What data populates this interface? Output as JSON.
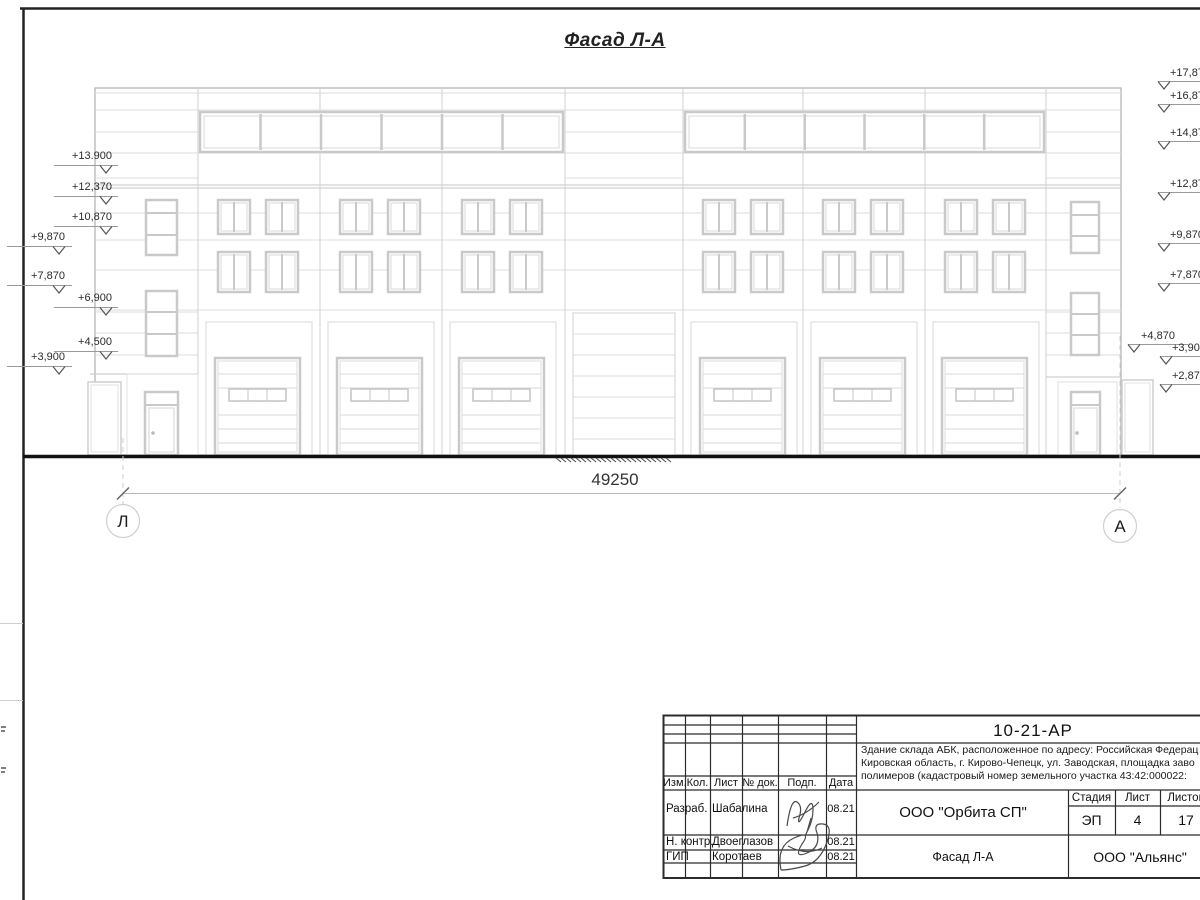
{
  "drawing_title": "Фасад Л-А",
  "colors": {
    "background": "#ffffff",
    "facade_line": "#d6d6d6",
    "frame_line": "#1c1c1c",
    "ground_line": "#111111"
  },
  "elevations": {
    "left": [
      "+13.900",
      "+12,370",
      "+10,870",
      "+9,870",
      "+7,870",
      "+6,900",
      "+4,500",
      "+3,900"
    ],
    "right": [
      "+17,87",
      "+16,87",
      "+14,87",
      "+12,87",
      "+9,870",
      "+7,870",
      "+4,870",
      "+3,900",
      "+2,870"
    ]
  },
  "dimension": {
    "overall_length": "49250"
  },
  "axes": {
    "left_label": "Л",
    "right_label": "А"
  },
  "title_block": {
    "document_code": "10-21-АР",
    "description_lines": [
      "Здание склада АБК, расположенное по адресу: Российская Федерац",
      "Кировская область, г. Кирово-Чепецк, ул. Заводская, площадка заво",
      "полимеров (кадастровый номер земельного участка 43:42:000022:"
    ],
    "columns": [
      "Изм.",
      "Кол.",
      "Лист",
      "№ док.",
      "Подп.",
      "Дата"
    ],
    "rows": [
      {
        "role": "Разраб.",
        "name": "Шабалина",
        "date": "08.21"
      },
      {
        "role": "Н. контр.",
        "name": "Двоеглазов",
        "date": "08.21"
      },
      {
        "role": "ГИП",
        "name": "Коротаев",
        "date": "08.21"
      }
    ],
    "organization": "ООО \"Орбита СП\"",
    "stage_label": "Стадия",
    "stage": "ЭП",
    "sheet_label": "Лист",
    "sheet": "4",
    "sheets_label": "Листов",
    "sheets": "17",
    "sheet_title": "Фасад Л-А",
    "contractor": "ООО \"Альянс\""
  }
}
